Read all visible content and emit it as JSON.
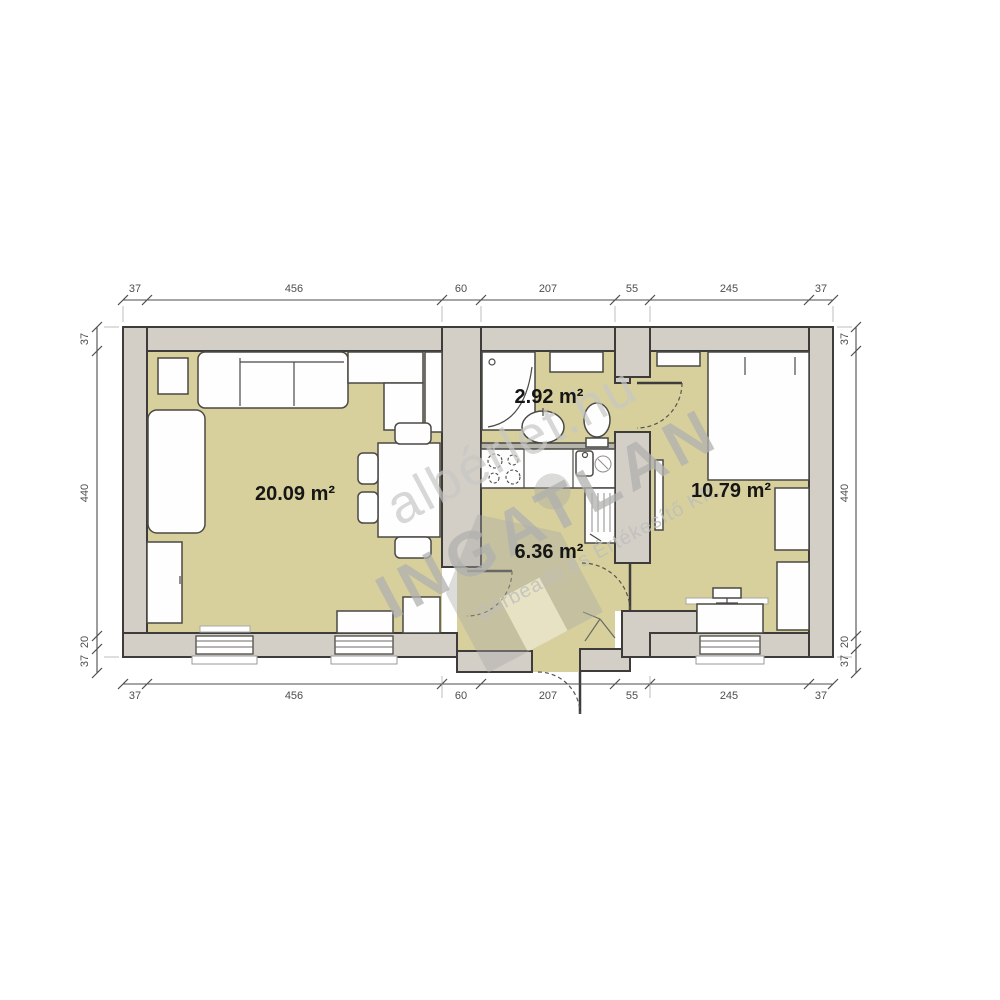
{
  "watermark": {
    "line1": "albérlet.hu",
    "line2": "INGATLAN",
    "line3": "Bérbeadó és Értékesítő Kft."
  },
  "rooms": {
    "living_room": {
      "area": "20.09 m²"
    },
    "bathroom": {
      "area": "2.92 m²"
    },
    "hall": {
      "area": "6.36 m²"
    },
    "bedroom": {
      "area": "10.79 m²"
    }
  },
  "dimensions": {
    "top": [
      "37",
      "456",
      "60",
      "207",
      "55",
      "245",
      "37"
    ],
    "bottom": [
      "37",
      "456",
      "60",
      "207",
      "55",
      "245",
      "37"
    ],
    "left": [
      "37",
      "440",
      "20",
      "37"
    ],
    "right": [
      "37",
      "440",
      "20",
      "37"
    ]
  },
  "colors": {
    "wall_fill": "#d3cfc7",
    "floor_fill": "#d7d09c",
    "outline": "#3d3c3a",
    "dimension_text": "#4e4d4b",
    "watermark_grey": "#b1b1af"
  }
}
